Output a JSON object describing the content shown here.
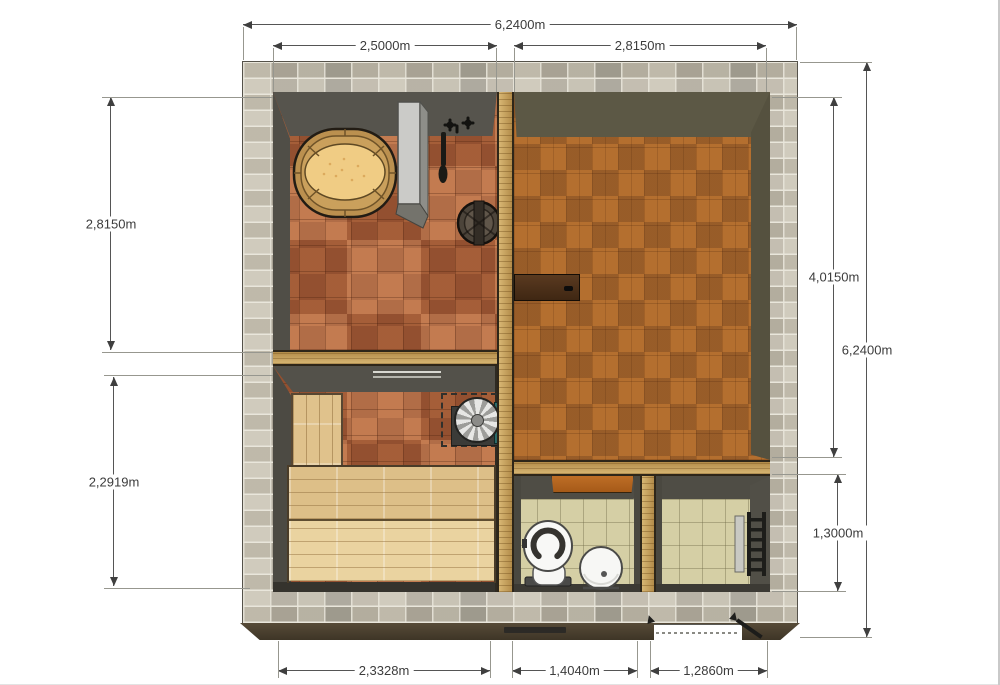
{
  "dimensions": {
    "top_total": "6,2400m",
    "top_left": "2,5000m",
    "top_right": "2,8150m",
    "left_upper": "2,8150m",
    "left_lower": "2,2919m",
    "right_inner": "4,0150m",
    "right_total": "6,2400m",
    "right_lower": "1,3000m",
    "bottom_left": "2,3328m",
    "bottom_middle": "1,4040m",
    "bottom_right": "1,2860m"
  },
  "palette": {
    "background": "#ffffff",
    "stone_wall": "#c6c0b1",
    "wall_face_dark": "#53524b",
    "wall_face_olive": "#5c5845",
    "wood_partition": "#c7a058",
    "terracotta_tile": "#b2653e",
    "parquet_floor": "#a8682e",
    "beige_tile": "#d5cfa5",
    "bench_wood": "#e0c28c",
    "door_dark_brown": "#4a2f17",
    "door_orange": "#b5651f",
    "stove_panel_teal": "#2d6b69",
    "bottom_wall_edge": "#433a2c",
    "dimension_line": "#4a4a4a"
  }
}
